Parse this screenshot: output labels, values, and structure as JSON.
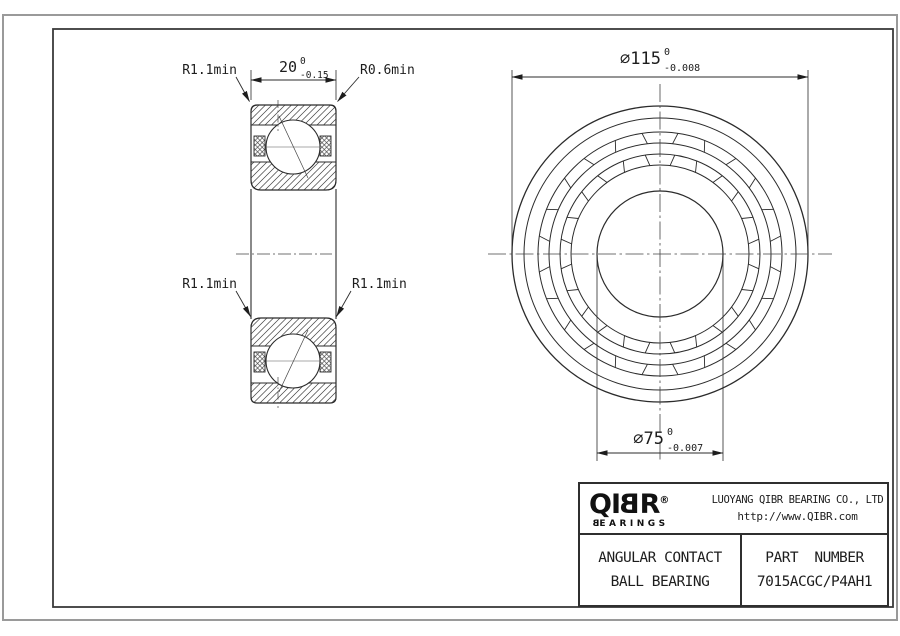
{
  "sheet": {
    "background": "#ffffff",
    "line_color": "#2b2b2b",
    "frame_outer_color": "#9a9a9a"
  },
  "callouts": {
    "radius_top_left": "R1.1min",
    "radius_top_right": "R0.6min",
    "radius_mid_left": "R1.1min",
    "radius_mid_right": "R1.1min"
  },
  "dimensions": {
    "width": {
      "value": "20",
      "tol_upper": "0",
      "tol_lower": "-0.15"
    },
    "outer_diameter": {
      "value": "⌀115",
      "tol_upper": "0",
      "tol_lower": "-0.008"
    },
    "bore_diameter": {
      "value": "⌀75",
      "tol_upper": "0",
      "tol_lower": "-0.007"
    }
  },
  "title_block": {
    "logo": {
      "brand_pre": "QI",
      "brand_b": "B",
      "brand_post": "R",
      "registered": "®",
      "wordmark_b": "B",
      "wordmark_rest": "EARINGS"
    },
    "company": {
      "name": "LUOYANG QIBR BEARING CO., LTD",
      "website": "http://www.QIBR.com"
    },
    "product": {
      "line1": "ANGULAR CONTACT",
      "line2": "BALL BEARING"
    },
    "part": {
      "label": "PART NUMBER",
      "number": "7015ACGC/P4AH1"
    }
  }
}
